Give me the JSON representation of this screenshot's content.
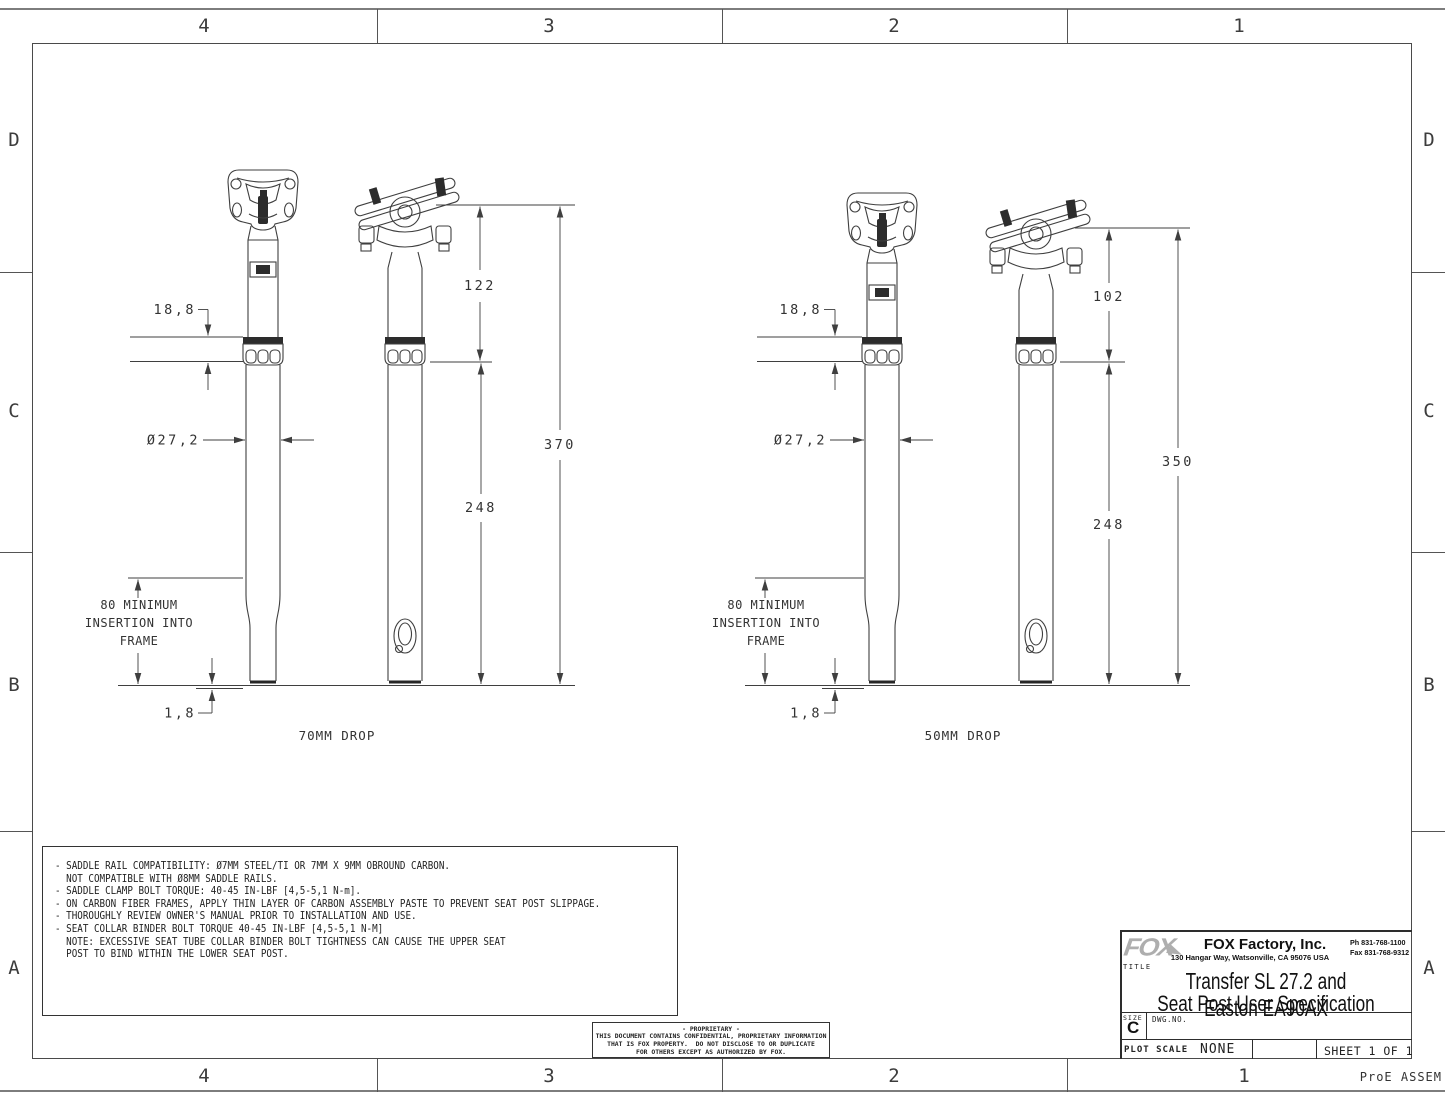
{
  "sheet": {
    "zone_cols": [
      "4",
      "3",
      "2",
      "1"
    ],
    "zone_rows": [
      "D",
      "C",
      "B",
      "A"
    ],
    "footer_right": "ProE ASSEM"
  },
  "views": [
    {
      "caption": "70MM DROP",
      "collar_stack": "18,8",
      "upper_length": "122",
      "total_length": "370",
      "lower_length": "248",
      "diameter": "Ø27,2",
      "insertion_line1": "80 MINIMUM",
      "insertion_line2": "INSERTION INTO",
      "insertion_line3": "FRAME",
      "tip_chamfer": "1,8"
    },
    {
      "caption": "50MM DROP",
      "collar_stack": "18,8",
      "upper_length": "102",
      "total_length": "350",
      "lower_length": "248",
      "diameter": "Ø27,2",
      "insertion_line1": "80 MINIMUM",
      "insertion_line2": "INSERTION INTO",
      "insertion_line3": "FRAME",
      "tip_chamfer": "1,8"
    }
  ],
  "notes": {
    "lines": [
      "- SADDLE RAIL COMPATIBILITY: Ø7MM STEEL/TI OR 7MM X 9MM OBROUND CARBON.",
      "  NOT COMPATIBLE WITH Ø8MM SADDLE RAILS.",
      "",
      "- SADDLE CLAMP BOLT TORQUE: 40-45 IN-LBF [4,5-5,1 N-m].",
      "",
      "- ON CARBON FIBER FRAMES, APPLY THIN LAYER OF CARBON ASSEMBLY PASTE TO PREVENT SEAT POST SLIPPAGE.",
      "",
      "- THOROUGHLY REVIEW OWNER'S MANUAL PRIOR TO INSTALLATION AND USE.",
      "",
      "- SEAT COLLAR BINDER BOLT TORQUE 40-45 IN-LBF [4,5-5,1 N-M]",
      "  NOTE: EXCESSIVE SEAT TUBE COLLAR BINDER BOLT TIGHTNESS CAN CAUSE THE UPPER SEAT",
      "  POST TO BIND WITHIN THE LOWER SEAT POST."
    ]
  },
  "proprietary": {
    "line1": "- PROPRIETARY -",
    "line2": "THIS DOCUMENT CONTAINS CONFIDENTIAL, PROPRIETARY INFORMATION",
    "line3": "THAT IS FOX PROPERTY.  DO NOT DISCLOSE TO OR DUPLICATE",
    "line4": "FOR OTHERS EXCEPT AS AUTHORIZED BY FOX."
  },
  "title_block": {
    "logo": "FOX",
    "company": "FOX Factory, Inc.",
    "address": "130 Hangar Way, Watsonville, CA 95076 USA",
    "phone": "Ph 831-768-1100",
    "fax": "Fax 831-768-9312",
    "title_label": "TITLE",
    "title_line1": "Transfer SL 27.2 and Easton EA90AX",
    "title_line2": "Seat Post User Specification",
    "size_label": "SIZE",
    "size_value": "C",
    "dwg_label": "DWG.NO.",
    "plot_scale_label": "PLOT SCALE",
    "plot_scale_value": "NONE",
    "sheet_label": "SHEET 1 OF 1"
  },
  "colors": {
    "line": "#3f3f3f",
    "frame": "#4a4a4a",
    "logo_gray": "#aeaeae"
  }
}
